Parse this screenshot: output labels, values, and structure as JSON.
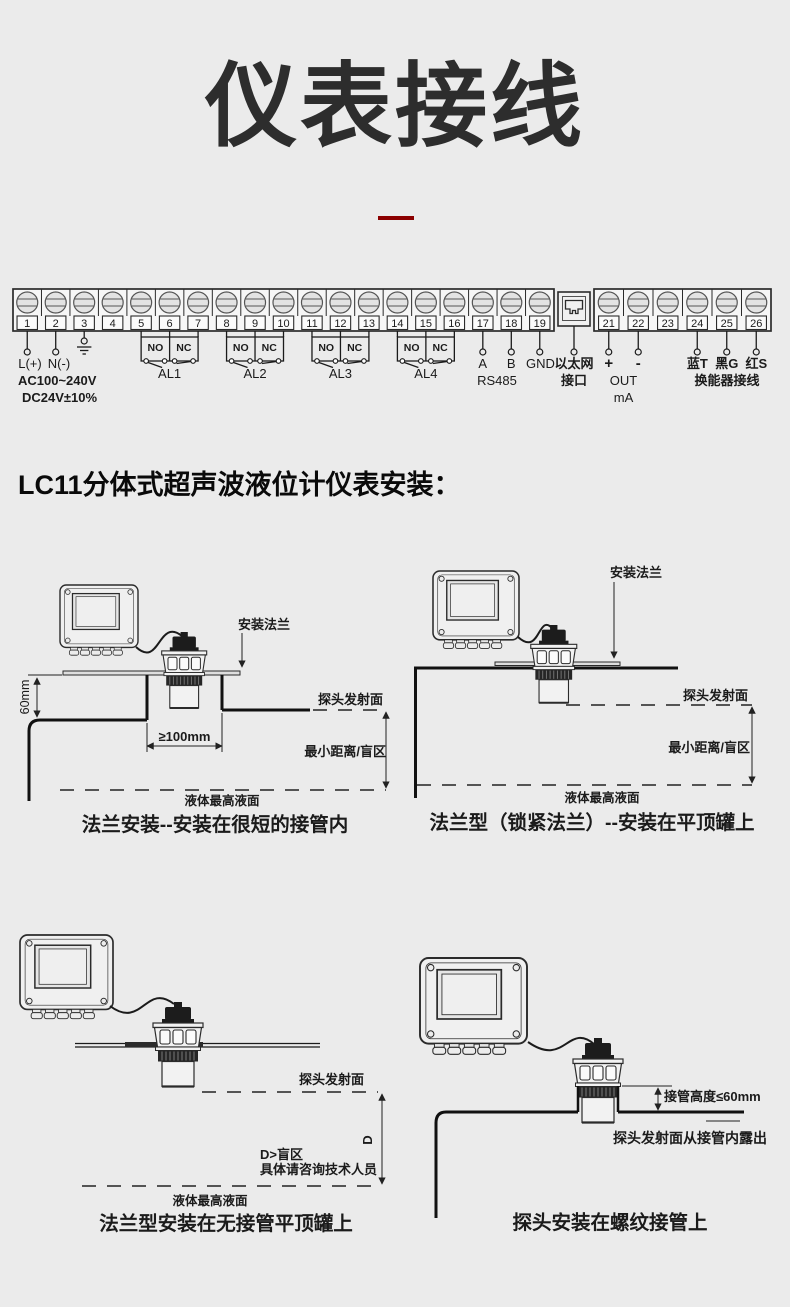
{
  "page": {
    "title": "仪表接线",
    "section_heading": "LC11分体式超声波液位计仪表安装："
  },
  "colors": {
    "background": "#ebebeb",
    "ink": "#1b1b1b",
    "accent_red": "#8b0000"
  },
  "terminal_strip": {
    "block1_numbers": [
      "1",
      "2",
      "3",
      "4",
      "5",
      "6",
      "7",
      "8",
      "9",
      "10",
      "11",
      "12",
      "13",
      "14",
      "15",
      "16",
      "17",
      "18",
      "19"
    ],
    "block2_numbers": [
      "21",
      "22",
      "23",
      "24",
      "25",
      "26"
    ],
    "power": {
      "l_label": "L(+)",
      "n_label": "N(-)",
      "volt_line1": "AC100~240V",
      "volt_line2": "DC24V±10%"
    },
    "relays": [
      {
        "no": "NO",
        "nc": "NC",
        "name": "AL1"
      },
      {
        "no": "NO",
        "nc": "NC",
        "name": "AL2"
      },
      {
        "no": "NO",
        "nc": "NC",
        "name": "AL3"
      },
      {
        "no": "NO",
        "nc": "NC",
        "name": "AL4"
      }
    ],
    "rs485": {
      "a": "A",
      "b": "B",
      "gnd": "GND",
      "bus_label": "RS485"
    },
    "ethernet": {
      "line1": "以太网",
      "line2": "接口"
    },
    "current_out": {
      "plus": "+",
      "minus": "-",
      "line1": "OUT",
      "line2": "mA"
    },
    "transducer": {
      "blue": "蓝T",
      "black": "黑G",
      "red": "红S",
      "label": "换能器接线"
    }
  },
  "panels": [
    {
      "caption": "法兰安装--安装在很短的接管内",
      "labels": {
        "mount_flange": "安装法兰",
        "dim_60mm": "60mm",
        "dim_100mm": "≥100mm",
        "probe_face": "探头发射面",
        "blind_zone": "最小距离/盲区",
        "max_level": "液体最高液面"
      }
    },
    {
      "caption": "法兰型（锁紧法兰）--安装在平顶罐上",
      "labels": {
        "mount_flange": "安装法兰",
        "probe_face": "探头发射面",
        "blind_zone": "最小距离/盲区",
        "max_level": "液体最高液面"
      }
    },
    {
      "caption": "法兰型安装在无接管平顶罐上",
      "labels": {
        "probe_face": "探头发射面",
        "d_dim": "D",
        "d_note_line1": "D>盲区",
        "d_note_line2": "具体请咨询技术人员",
        "max_level": "液体最高液面"
      }
    },
    {
      "caption": "探头安装在螺纹接管上",
      "labels": {
        "nozzle_height": "接管高度≤60mm",
        "probe_face_note": "探头发射面从接管内露出"
      }
    }
  ]
}
